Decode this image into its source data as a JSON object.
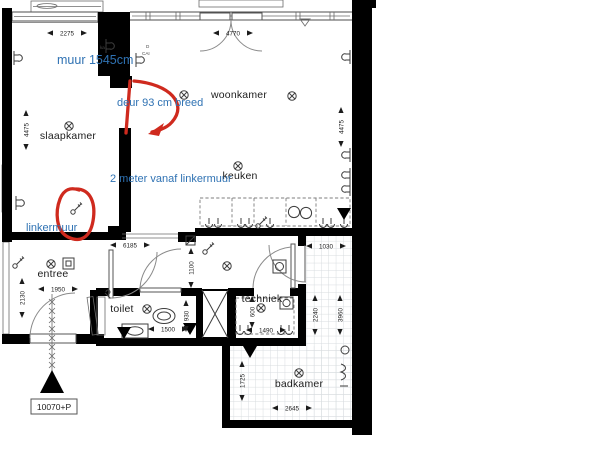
{
  "document": {
    "type": "floor-plan",
    "language": "nl"
  },
  "rooms": {
    "slaapkamer": "slaapkamer",
    "woonkamer": "woonkamer",
    "keuken": "keuken",
    "entree": "entree",
    "toilet": "toilet",
    "techniek": "techniek",
    "badkamer": "badkamer"
  },
  "annotations": {
    "muur": "muur 1545cm",
    "deur": "deur 93 cm breed",
    "afstand": "2 meter vanaf linkermuur",
    "linkermuur": "linkermuur",
    "blue_color": "#2f72b3",
    "red_color": "#cf2a1e"
  },
  "dimensions": {
    "d2275": "2275",
    "d4475_links": "4475",
    "d4770": "4770",
    "d4475_rechts": "4475",
    "d6185": "6185",
    "d1030": "1030",
    "d1100": "1100",
    "d1950": "1950",
    "d2130": "2130",
    "d1500": "1500",
    "d930": "930",
    "d600": "600",
    "d1490": "1490",
    "d2240": "2240",
    "d3960": "3960",
    "d1725": "1725",
    "d2645": "2645"
  },
  "wall_labels": {
    "ka": "ka",
    "d": "D",
    "cai": "CAI"
  },
  "elevation_marker": "10070+P",
  "colors": {
    "wall": "#000000",
    "line": "#4d4d4d",
    "tile_line": "#d8dcdf",
    "background": "#ffffff",
    "text": "#1c1c1c"
  }
}
